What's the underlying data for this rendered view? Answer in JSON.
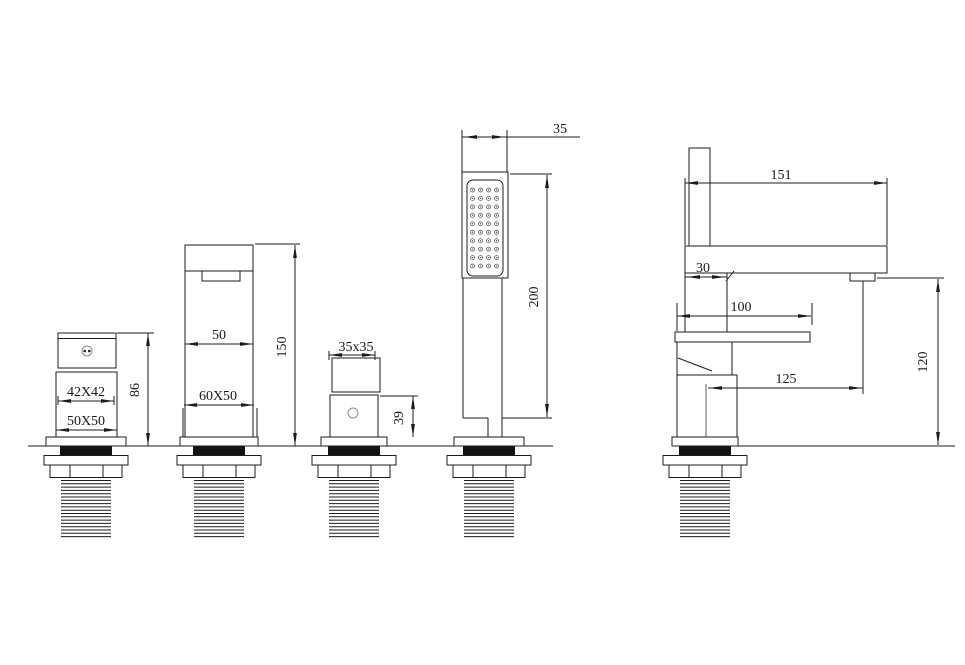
{
  "drawing": {
    "kind": "bath-faucet-installation-dimension-drawing",
    "line_color": "#1c1c1c",
    "background": "#ffffff",
    "views": {
      "diverter": {
        "width": "42X42",
        "base": "50X50",
        "height": "86"
      },
      "spout": {
        "width": "50",
        "base": "60X50",
        "height": "150"
      },
      "handle": {
        "plan": "35x35",
        "height": "39"
      },
      "shower": {
        "width": "35",
        "height": "200"
      },
      "side": {
        "length": "151",
        "offset": "30",
        "lever": "100",
        "reach": "125",
        "outlet_height": "120"
      }
    }
  }
}
